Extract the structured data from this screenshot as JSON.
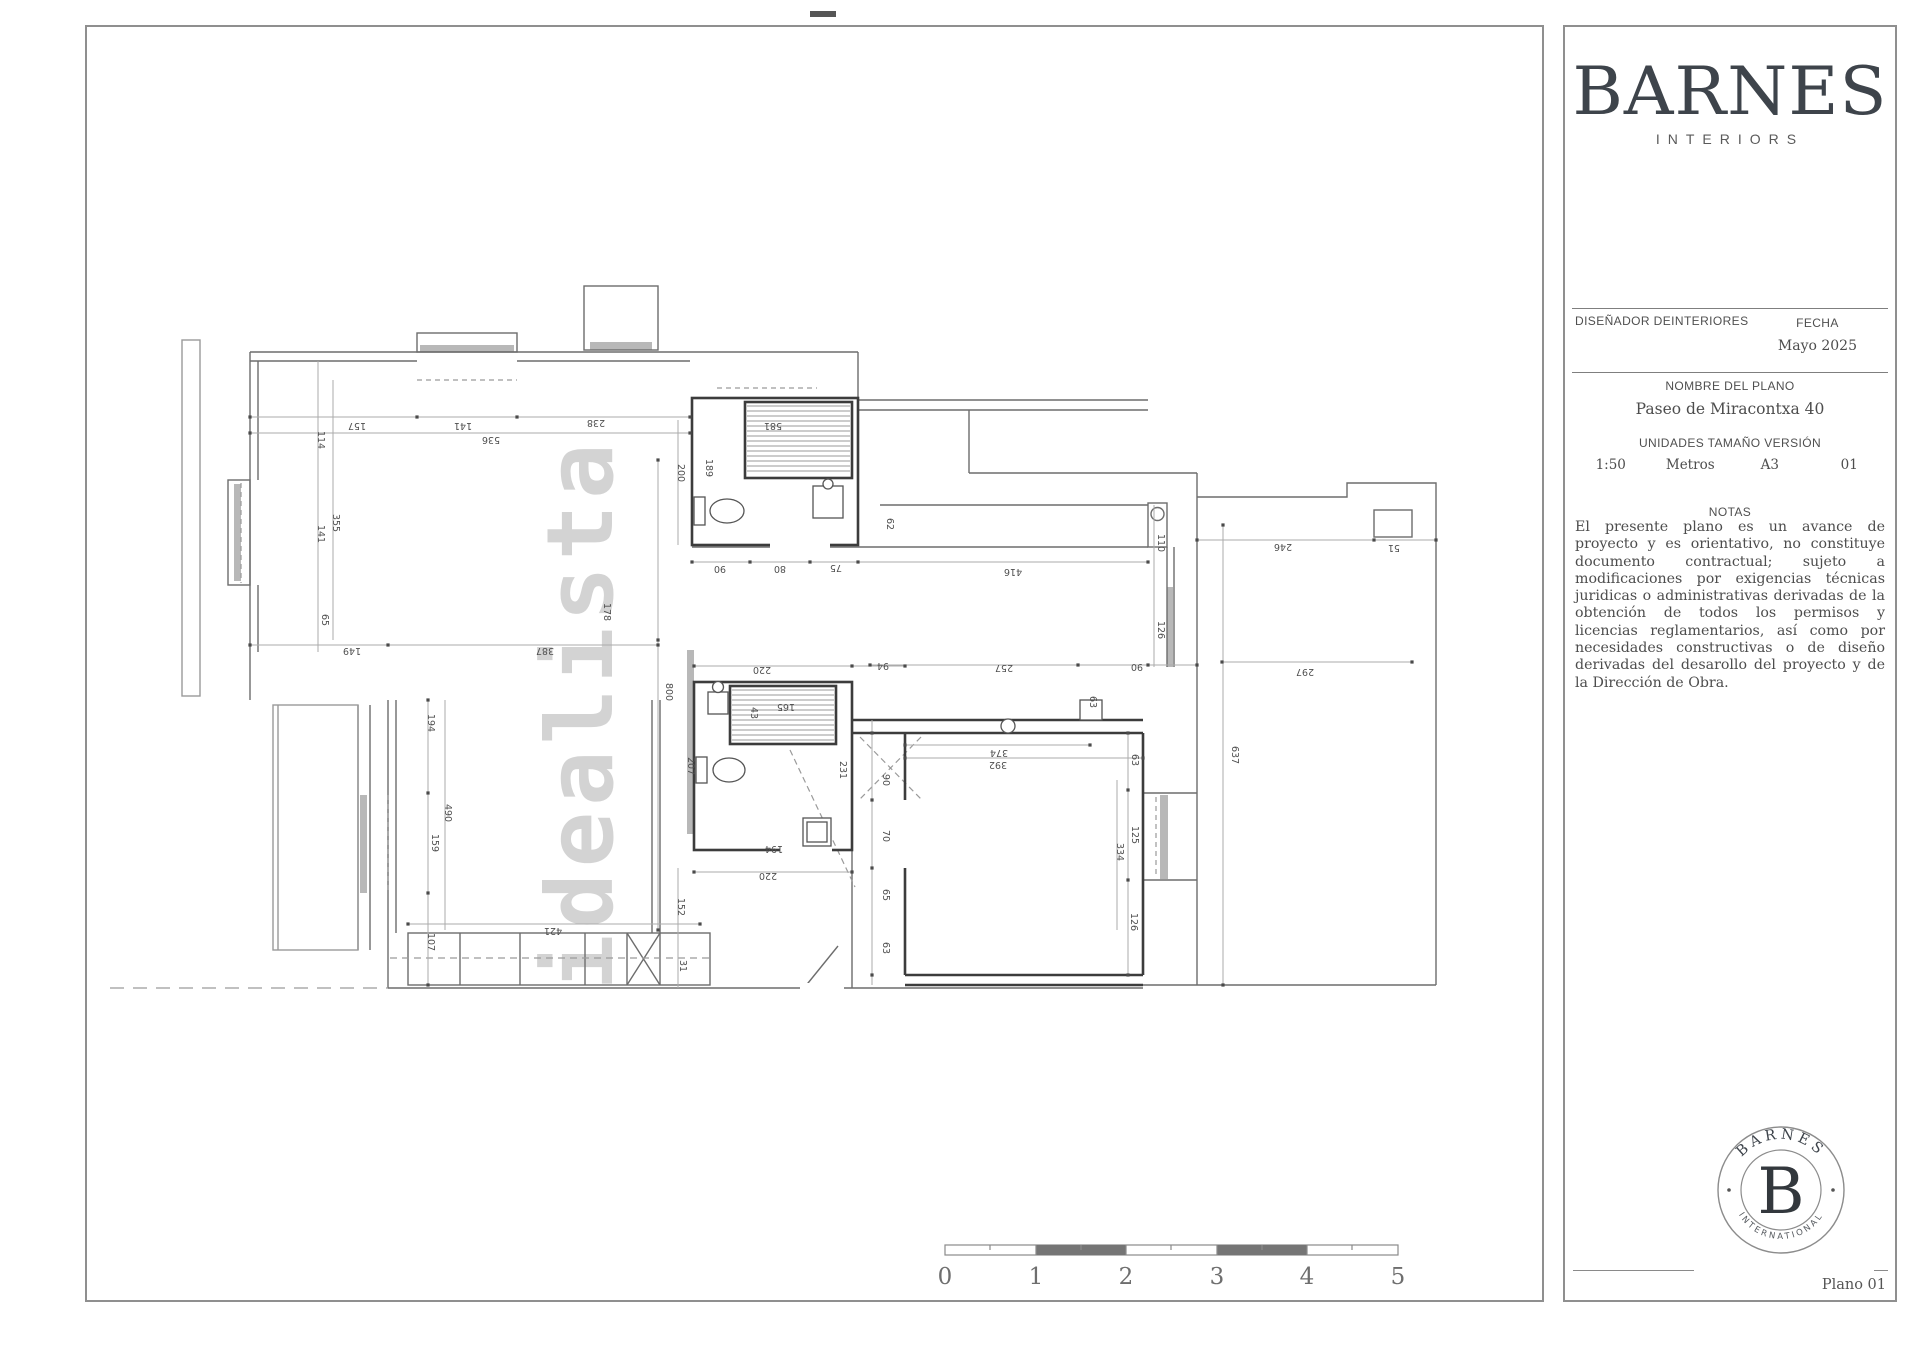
{
  "panel": {
    "brand": "BARNES",
    "brand_sub": "INTERIORS",
    "designer_label": "DISEÑADOR DEINTERIORES",
    "fecha_label": "FECHA",
    "fecha_value": "Mayo 2025",
    "plan_name_label": "NOMBRE DEL PLANO",
    "plan_name_value": "Paseo de Miracontxa 40",
    "units_label": "UNIDADES TAMAÑO VERSIÓN",
    "units_values": [
      "1:50",
      "Metros",
      "A3",
      "01"
    ],
    "notas_label": "NOTAS",
    "notas_text": "El presente plano es un avance de proyecto y es orientativo, no constituye documento contractual; sujeto a modificaciones por exigencias técnicas juridicas o administrativas derivadas de la obtención de todos los permisos y licencias reglamentarios, así como por necesidades constructivas o de diseño derivadas del desarollo del proyecto y de la Dirección de Obra.",
    "seal": {
      "top": "BARNES",
      "letter": "B",
      "bottom": "INTERNATIONAL"
    },
    "page_label": "Plano 01"
  },
  "watermark": "idealista",
  "scalebar": {
    "ticks": [
      "0",
      "1",
      "2",
      "3",
      "4",
      "5"
    ]
  },
  "plan": {
    "dimensions": [
      {
        "t": "157",
        "x": 357,
        "y": 423,
        "r": 180
      },
      {
        "t": "141",
        "x": 463,
        "y": 423,
        "r": 180
      },
      {
        "t": "238",
        "x": 596,
        "y": 420,
        "r": 180
      },
      {
        "t": "536",
        "x": 491,
        "y": 437,
        "r": 180
      },
      {
        "t": "114",
        "x": 318,
        "y": 440,
        "r": 90
      },
      {
        "t": "355",
        "x": 333,
        "y": 523,
        "r": 90
      },
      {
        "t": "141",
        "x": 318,
        "y": 534,
        "r": 90
      },
      {
        "t": "65",
        "x": 322,
        "y": 620,
        "r": 90
      },
      {
        "t": "149",
        "x": 352,
        "y": 648,
        "r": 180
      },
      {
        "t": "387",
        "x": 545,
        "y": 648,
        "r": 180
      },
      {
        "t": "178",
        "x": 604,
        "y": 612,
        "r": 90
      },
      {
        "t": "800",
        "x": 666,
        "y": 692,
        "r": 90
      },
      {
        "t": "90",
        "x": 720,
        "y": 566,
        "r": 180
      },
      {
        "t": "80",
        "x": 780,
        "y": 566,
        "r": 180
      },
      {
        "t": "75",
        "x": 836,
        "y": 565,
        "r": 180
      },
      {
        "t": "416",
        "x": 1013,
        "y": 569,
        "r": 180
      },
      {
        "t": "110",
        "x": 1158,
        "y": 543,
        "r": 90
      },
      {
        "t": "581",
        "x": 773,
        "y": 423,
        "r": 180
      },
      {
        "t": "189",
        "x": 706,
        "y": 468,
        "r": 90
      },
      {
        "t": "200",
        "x": 678,
        "y": 473,
        "r": 90
      },
      {
        "t": "62",
        "x": 887,
        "y": 524,
        "r": 90
      },
      {
        "t": "257",
        "x": 1004,
        "y": 665,
        "r": 180
      },
      {
        "t": "90",
        "x": 1137,
        "y": 664,
        "r": 180
      },
      {
        "t": "126",
        "x": 1158,
        "y": 630,
        "r": 90
      },
      {
        "t": "246",
        "x": 1283,
        "y": 544,
        "r": 180
      },
      {
        "t": "51",
        "x": 1394,
        "y": 545,
        "r": 180
      },
      {
        "t": "297",
        "x": 1305,
        "y": 669,
        "r": 180
      },
      {
        "t": "637",
        "x": 1232,
        "y": 755,
        "r": 90
      },
      {
        "t": "220",
        "x": 762,
        "y": 667,
        "r": 180
      },
      {
        "t": "94",
        "x": 883,
        "y": 663,
        "r": 180
      },
      {
        "t": "63",
        "x": 1090,
        "y": 702,
        "r": 90
      },
      {
        "t": "165",
        "x": 786,
        "y": 704,
        "r": 180
      },
      {
        "t": "43",
        "x": 751,
        "y": 713,
        "r": 90
      },
      {
        "t": "207",
        "x": 688,
        "y": 766,
        "r": 90
      },
      {
        "t": "194",
        "x": 774,
        "y": 846,
        "r": 180
      },
      {
        "t": "231",
        "x": 840,
        "y": 770,
        "r": 90
      },
      {
        "t": "220",
        "x": 768,
        "y": 873,
        "r": 180
      },
      {
        "t": "374",
        "x": 999,
        "y": 750,
        "r": 180
      },
      {
        "t": "392",
        "x": 998,
        "y": 762,
        "r": 180
      },
      {
        "t": "90",
        "x": 883,
        "y": 780,
        "r": 90
      },
      {
        "t": "70",
        "x": 883,
        "y": 836,
        "r": 90
      },
      {
        "t": "65",
        "x": 883,
        "y": 895,
        "r": 90
      },
      {
        "t": "63",
        "x": 883,
        "y": 948,
        "r": 90
      },
      {
        "t": "63",
        "x": 1132,
        "y": 760,
        "r": 90
      },
      {
        "t": "125",
        "x": 1132,
        "y": 835,
        "r": 90
      },
      {
        "t": "334",
        "x": 1117,
        "y": 852,
        "r": 90
      },
      {
        "t": "126",
        "x": 1131,
        "y": 922,
        "r": 90
      },
      {
        "t": "194",
        "x": 428,
        "y": 723,
        "r": 90
      },
      {
        "t": "490",
        "x": 445,
        "y": 813,
        "r": 90
      },
      {
        "t": "159",
        "x": 432,
        "y": 843,
        "r": 90
      },
      {
        "t": "421",
        "x": 553,
        "y": 928,
        "r": 180
      },
      {
        "t": "107",
        "x": 428,
        "y": 942,
        "r": 90
      },
      {
        "t": "152",
        "x": 678,
        "y": 907,
        "r": 90
      },
      {
        "t": "31",
        "x": 680,
        "y": 966,
        "r": 90
      }
    ]
  }
}
